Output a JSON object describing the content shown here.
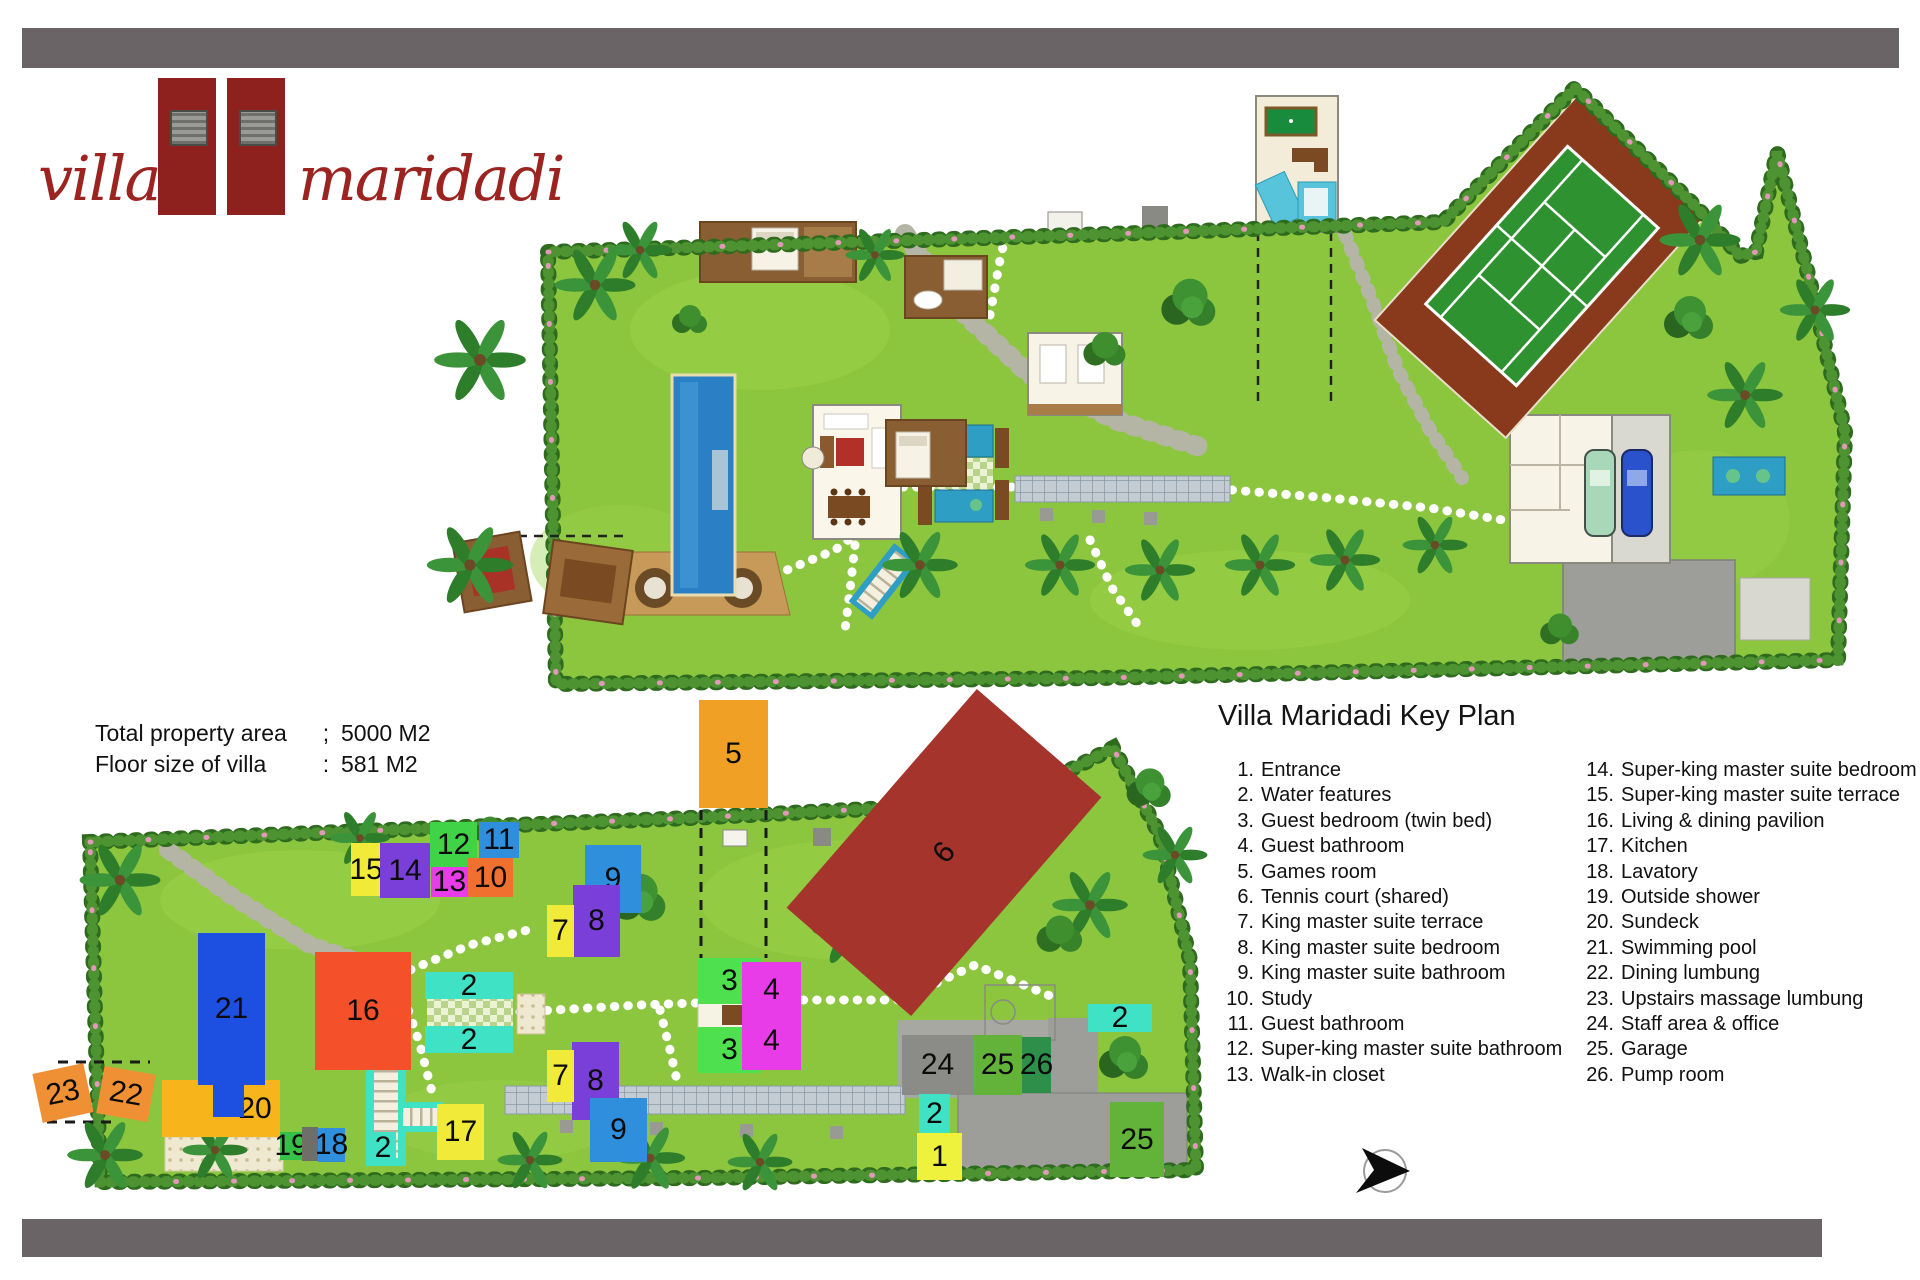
{
  "logo": {
    "word_left": "villa",
    "word_right": "maridadi"
  },
  "property_info": {
    "rows": [
      {
        "label": "Total property area",
        "sep": ";",
        "value": "5000 M2"
      },
      {
        "label": "Floor size of villa",
        "sep": ":",
        "value": "581 M2"
      }
    ]
  },
  "key_plan": {
    "title": "Villa Maridadi Key Plan",
    "legend_left": [
      {
        "num": "1.",
        "label": "Entrance"
      },
      {
        "num": "2.",
        "label": "Water features"
      },
      {
        "num": "3.",
        "label": "Guest bedroom (twin bed)"
      },
      {
        "num": "4.",
        "label": "Guest bathroom"
      },
      {
        "num": "5.",
        "label": "Games room"
      },
      {
        "num": "6.",
        "label": "Tennis court (shared)"
      },
      {
        "num": "7.",
        "label": "King master suite terrace"
      },
      {
        "num": "8.",
        "label": "King master suite bedroom"
      },
      {
        "num": "9.",
        "label": "King master suite bathroom"
      },
      {
        "num": "10.",
        "label": "Study"
      },
      {
        "num": "11.",
        "label": "Guest bathroom"
      },
      {
        "num": "12.",
        "label": "Super-king master suite bathroom"
      },
      {
        "num": "13.",
        "label": "Walk-in closet"
      }
    ],
    "legend_right": [
      {
        "num": "14.",
        "label": "Super-king master suite bedroom"
      },
      {
        "num": "15.",
        "label": "Super-king master suite terrace"
      },
      {
        "num": "16.",
        "label": "Living & dining pavilion"
      },
      {
        "num": "17.",
        "label": "Kitchen"
      },
      {
        "num": "18.",
        "label": "Lavatory"
      },
      {
        "num": "19.",
        "label": "Outside shower"
      },
      {
        "num": "20.",
        "label": "Sundeck"
      },
      {
        "num": "21.",
        "label": "Swimming pool"
      },
      {
        "num": "22.",
        "label": "Dining lumbung"
      },
      {
        "num": "23.",
        "label": "Upstairs massage lumbung"
      },
      {
        "num": "24.",
        "label": "Staff area & office"
      },
      {
        "num": "25.",
        "label": "Garage"
      },
      {
        "num": "26.",
        "label": "Pump room"
      }
    ]
  },
  "markers": [
    {
      "id": "5",
      "label": "5",
      "x": 699,
      "y": 700,
      "w": 69,
      "h": 108,
      "color": "#f0a125"
    },
    {
      "id": "6",
      "label": "6",
      "x": 799,
      "y": 770,
      "w": 290,
      "h": 165,
      "color": "#a5342c",
      "rotate": -49
    },
    {
      "id": "15",
      "label": "15",
      "x": 351,
      "y": 843,
      "w": 30,
      "h": 53,
      "color": "#f2ea38"
    },
    {
      "id": "14",
      "label": "14",
      "x": 380,
      "y": 843,
      "w": 50,
      "h": 55,
      "color": "#7b3fd9"
    },
    {
      "id": "12",
      "label": "12",
      "x": 430,
      "y": 822,
      "w": 47,
      "h": 45,
      "color": "#40d348"
    },
    {
      "id": "11",
      "label": "11",
      "x": 479,
      "y": 822,
      "w": 40,
      "h": 36,
      "color": "#2f8fdd"
    },
    {
      "id": "13",
      "label": "13",
      "x": 431,
      "y": 867,
      "w": 37,
      "h": 30,
      "color": "#e93ce9"
    },
    {
      "id": "10",
      "label": "10",
      "x": 468,
      "y": 858,
      "w": 45,
      "h": 39,
      "color": "#f07030"
    },
    {
      "id": "9a",
      "label": "9",
      "x": 585,
      "y": 845,
      "w": 56,
      "h": 68,
      "color": "#2f8fdd"
    },
    {
      "id": "8a",
      "label": "8",
      "x": 573,
      "y": 885,
      "w": 47,
      "h": 72,
      "color": "#7b3fd9"
    },
    {
      "id": "7a",
      "label": "7",
      "x": 547,
      "y": 905,
      "w": 27,
      "h": 52,
      "color": "#f2ea38"
    },
    {
      "id": "2a",
      "label": "2",
      "x": 425,
      "y": 972,
      "w": 88,
      "h": 27,
      "color": "#3fe2c5"
    },
    {
      "id": "2b",
      "label": "2",
      "x": 425,
      "y": 1026,
      "w": 88,
      "h": 27,
      "color": "#3fe2c5"
    },
    {
      "id": "16",
      "label": "16",
      "x": 315,
      "y": 952,
      "w": 96,
      "h": 118,
      "color": "#f4512b"
    },
    {
      "id": "20",
      "label": "20",
      "x": 162,
      "y": 1080,
      "w": 118,
      "h": 57,
      "color": "#f7b51b",
      "tx": 34
    },
    {
      "id": "21",
      "label": "21",
      "x": 198,
      "y": 933,
      "w": 67,
      "h": 152,
      "color": "#1d50e0"
    },
    {
      "id": "21b",
      "label": "",
      "x": 213,
      "y": 1085,
      "w": 31,
      "h": 32,
      "color": "#1d50e0"
    },
    {
      "id": "23",
      "label": "23",
      "x": 37,
      "y": 1068,
      "w": 52,
      "h": 50,
      "color": "#f09035",
      "rotate": -12
    },
    {
      "id": "22",
      "label": "22",
      "x": 100,
      "y": 1070,
      "w": 52,
      "h": 48,
      "color": "#f09035",
      "rotate": 10
    },
    {
      "id": "19",
      "label": "19",
      "x": 280,
      "y": 1132,
      "w": 22,
      "h": 28,
      "color": "#35c049"
    },
    {
      "id": "19b",
      "label": "",
      "x": 302,
      "y": 1127,
      "w": 16,
      "h": 34,
      "color": "#6f6f69"
    },
    {
      "id": "18",
      "label": "18",
      "x": 318,
      "y": 1128,
      "w": 27,
      "h": 34,
      "color": "#2f8fdd"
    },
    {
      "id": "2c",
      "label": "2",
      "x": 370,
      "y": 1132,
      "w": 26,
      "h": 31,
      "color": "#3fe2c5"
    },
    {
      "id": "17",
      "label": "17",
      "x": 437,
      "y": 1104,
      "w": 47,
      "h": 56,
      "color": "#f2ea38"
    },
    {
      "id": "8b",
      "label": "8",
      "x": 572,
      "y": 1042,
      "w": 47,
      "h": 78,
      "color": "#7b3fd9"
    },
    {
      "id": "7b",
      "label": "7",
      "x": 547,
      "y": 1050,
      "w": 27,
      "h": 52,
      "color": "#f2ea38"
    },
    {
      "id": "9b",
      "label": "9",
      "x": 590,
      "y": 1098,
      "w": 57,
      "h": 64,
      "color": "#2f8fdd"
    },
    {
      "id": "3a",
      "label": "3",
      "x": 698,
      "y": 958,
      "w": 63,
      "h": 46,
      "color": "#4fe04f"
    },
    {
      "id": "4a",
      "label": "4",
      "x": 742,
      "y": 962,
      "w": 59,
      "h": 55,
      "color": "#e93ce9"
    },
    {
      "id": "3b",
      "label": "3",
      "x": 698,
      "y": 1027,
      "w": 63,
      "h": 46,
      "color": "#4fe04f"
    },
    {
      "id": "4b",
      "label": "4",
      "x": 742,
      "y": 1012,
      "w": 59,
      "h": 58,
      "color": "#e93ce9"
    },
    {
      "id": "24",
      "label": "24",
      "x": 902,
      "y": 1035,
      "w": 71,
      "h": 60,
      "color": "#8b8b87"
    },
    {
      "id": "25a",
      "label": "25",
      "x": 973,
      "y": 1035,
      "w": 49,
      "h": 60,
      "color": "#63b33b"
    },
    {
      "id": "26",
      "label": "26",
      "x": 1022,
      "y": 1037,
      "w": 29,
      "h": 56,
      "color": "#2e8f4a"
    },
    {
      "id": "2d",
      "label": "2",
      "x": 1088,
      "y": 1004,
      "w": 64,
      "h": 28,
      "color": "#3fe2c5"
    },
    {
      "id": "2e",
      "label": "2",
      "x": 919,
      "y": 1094,
      "w": 31,
      "h": 39,
      "color": "#3fe2c5"
    },
    {
      "id": "1",
      "label": "1",
      "x": 917,
      "y": 1133,
      "w": 45,
      "h": 47,
      "color": "#eef23c"
    },
    {
      "id": "25b",
      "label": "25",
      "x": 1110,
      "y": 1102,
      "w": 54,
      "h": 75,
      "color": "#63b33b"
    }
  ],
  "colors": {
    "bar": "#6a6466",
    "logo_red": "#9c2420",
    "grass": "#8cc63e",
    "hedge": "#2e6b1e",
    "pool_blue": "#2b7fc4",
    "tennis_surround": "#8a3a1c",
    "tennis_court": "#2f9231",
    "driveway_gray": "#9d9d99",
    "water_feature": "#2e9ec4"
  }
}
